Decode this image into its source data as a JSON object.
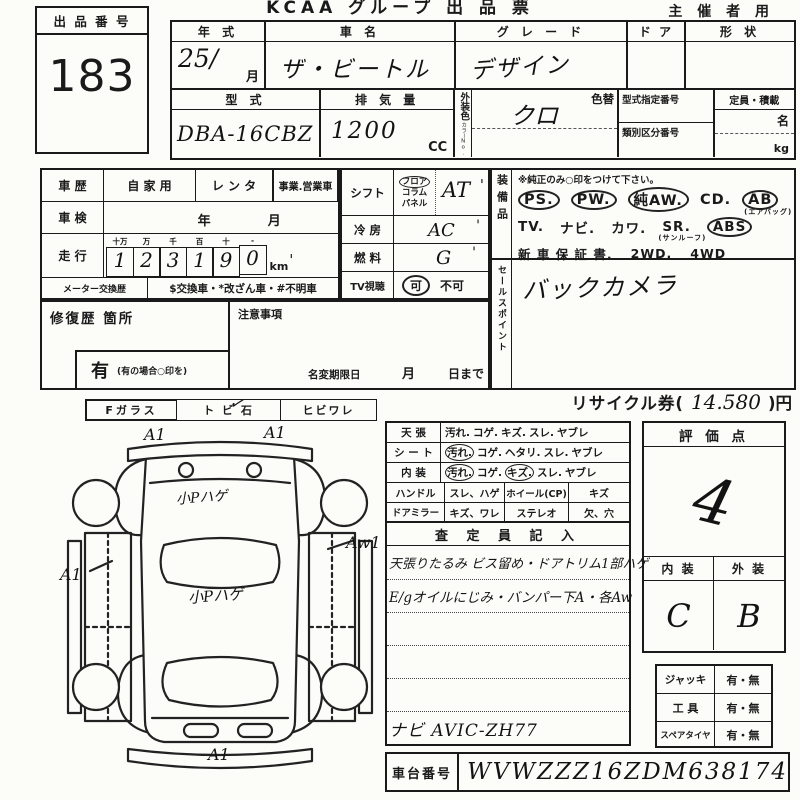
{
  "colors": {
    "ink": "#1a1a1a",
    "paper": "#fcfcf9"
  },
  "header": {
    "title": "KCAA グループ 出 品 票",
    "organizer": "主 催 者 用",
    "lot_label": "出 品 番 号",
    "lot_number": "183"
  },
  "top": {
    "year_label": "年  式",
    "year_value": "25/",
    "month_suffix": "月",
    "car_label": "車  名",
    "car_value": "ザ・ビートル",
    "grade_label": "グ レ ー ド",
    "grade_value": "デザイン",
    "door_label": "ド ア",
    "shape_label": "形 状",
    "model_label": "型  式",
    "model_value": "DBA-16CBZ",
    "disp_label": "排 気 量",
    "disp_value": "1200",
    "disp_unit": "CC",
    "color_label": "外装色",
    "color_no": "カラーNo.",
    "color_change": "色替",
    "color_value": "クロ",
    "type_no_label": "型式指定番号",
    "class_no_label": "類別区分番号",
    "capacity_label": "定員・積載",
    "capacity_persons": "名",
    "capacity_kg": "kg"
  },
  "history": {
    "label": "車 歴",
    "own": "自 家 用",
    "rental": "レ ン タ",
    "business": "事業.営業車",
    "inspection_label": "車 検",
    "year": "年",
    "month": "月",
    "mileage_label": "走 行",
    "digit_units": [
      "十万",
      "万",
      "千",
      "百",
      "十",
      "-"
    ],
    "digits": [
      "1",
      "2",
      "3",
      "1",
      "9",
      "0"
    ],
    "km": "km",
    "km_tick": "'",
    "meter_label": "メーター交換歴",
    "meter_note": "$交換車・*改ざん車・#不明車"
  },
  "shift": {
    "label": "シフト",
    "opt1": "フロア",
    "opt2": "コラム",
    "opt3": "パネル",
    "value": "AT",
    "tick": "'",
    "ac_label": "冷 房",
    "ac_value": "AC",
    "fuel_label": "燃 料",
    "fuel_value": "G",
    "tv_label": "TV視聴",
    "tv_ok": "可",
    "tv_ng": "不可"
  },
  "equipment": {
    "label": "装備品",
    "note": "※純正のみ○印をつけて下さい。",
    "r1": [
      "PS.",
      "PW.",
      "純AW.",
      "CD.",
      "AB"
    ],
    "airbag": "(エアバッグ)",
    "r2": [
      "TV.",
      "ナビ.",
      "カワ.",
      "SR.",
      "ABS"
    ],
    "sunroof": "(サンルーフ)",
    "r3": [
      "新 車 保 証 書.",
      "2WD.",
      "4WD"
    ]
  },
  "sales": {
    "label": "セールスポイント",
    "value": "バックカメラ"
  },
  "repair": {
    "label": "修復歴  箇所",
    "yes": "有",
    "yes_note": "(有の場合○印を)"
  },
  "caution": {
    "label": "注意事項",
    "rename": "名変期限日",
    "month": "月",
    "until": "日まで"
  },
  "glass": {
    "f": "Fガラス",
    "stone": "ト ビ 石",
    "crack": "ヒビワレ",
    "check": "✓"
  },
  "recycle": {
    "prefix": "リサイクル券(",
    "amount": "14.580",
    "suffix": ")円"
  },
  "condition": {
    "rows": [
      {
        "label": "天  張",
        "items": [
          "汚れ.",
          "コゲ.",
          "キズ.",
          "スレ.",
          "ヤブレ"
        ]
      },
      {
        "label": "シ ー ト",
        "items": [
          "汚れ.",
          "コゲ.",
          "ヘタリ.",
          "スレ.",
          "ヤブレ"
        ]
      },
      {
        "label": "内  装",
        "items": [
          "汚れ.",
          "コゲ.",
          "キズ.",
          "スレ.",
          "ヤブレ"
        ]
      }
    ],
    "handle_label": "ハンドル",
    "handle_val": "スレ、ハゲ",
    "wheel_label": "ホイール(CP)",
    "wheel_val": "キズ",
    "mirror_label": "ドアミラー",
    "mirror_val": "キズ、ワレ",
    "stereo_label": "ステレオ",
    "stereo_val": "欠、穴",
    "inspector_header": "査 定 員 記 入",
    "note1": "天張りたるみ ビス留め・ドアトリム1部ハゲ",
    "note2": "E/gオイルにじみ・バンパー下A・各Aw",
    "navi": "ナビ AVIC-ZH77"
  },
  "rating": {
    "header": "評  価  点",
    "score": "4",
    "interior_label": "内  装",
    "exterior_label": "外  装",
    "interior": "C",
    "exterior": "B"
  },
  "accessories": {
    "jack": "ジャッキ",
    "tools": "工  具",
    "spare": "スペアタイヤ",
    "yesno": "有・無"
  },
  "chassis": {
    "label": "車台番号",
    "value": "WVWZZZ16ZDM638174"
  },
  "diagram": {
    "hood_left": "A1",
    "hood_right": "A1",
    "side_left": "A1",
    "side_right": "Aw1",
    "rear": "A1",
    "hood_note": "小Pハゲ",
    "roof_note": "小Pハゲ"
  }
}
